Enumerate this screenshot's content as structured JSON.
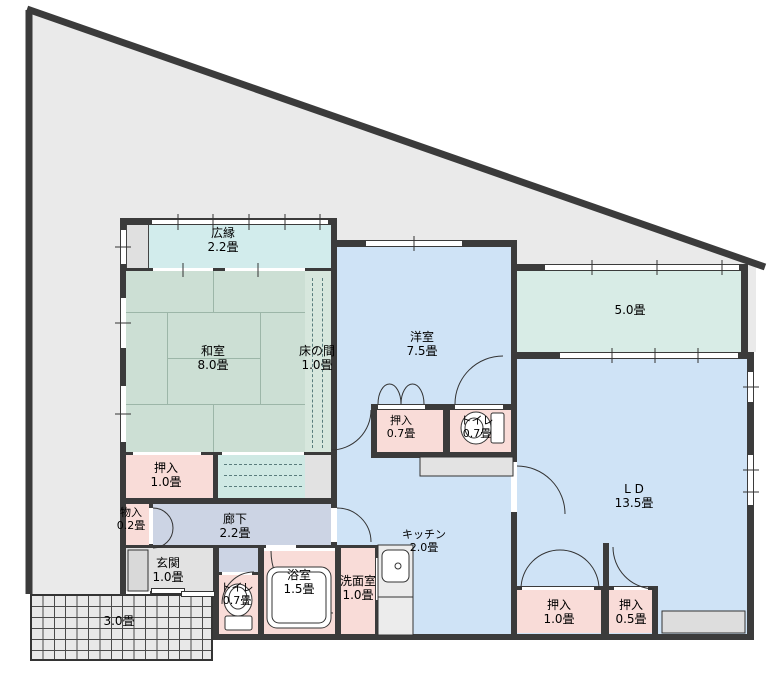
{
  "floor_plan": {
    "rooms": [
      {
        "id": "hiroen",
        "label": "広縁",
        "size": "2.2畳"
      },
      {
        "id": "washitsu",
        "label": "和室",
        "size": "8.0畳"
      },
      {
        "id": "tokonoma",
        "label": "床の間",
        "size": "1.0畳"
      },
      {
        "id": "youshitsu",
        "label": "洋室",
        "size": "7.5畳"
      },
      {
        "id": "room-5",
        "label": "",
        "size": "5.0畳"
      },
      {
        "id": "living-dining",
        "label": "L D",
        "size": "13.5畳"
      },
      {
        "id": "oshiire-youshitsu",
        "label": "押入",
        "size": "0.7畳"
      },
      {
        "id": "toilet-upper",
        "label": "トイレ",
        "size": "0.7畳"
      },
      {
        "id": "oshiire-washitsu",
        "label": "押入",
        "size": "1.0畳"
      },
      {
        "id": "monoire",
        "label": "物入",
        "size": "0.2畳"
      },
      {
        "id": "rouka",
        "label": "廊下",
        "size": "2.2畳"
      },
      {
        "id": "genkan",
        "label": "玄関",
        "size": "1.0畳"
      },
      {
        "id": "toilet-lower",
        "label": "トイレ",
        "size": "0.7畳"
      },
      {
        "id": "yokushitsu",
        "label": "浴室",
        "size": "1.5畳"
      },
      {
        "id": "senmenshitsu",
        "label": "洗面室",
        "size": "1.0畳"
      },
      {
        "id": "kitchen",
        "label": "キッチン",
        "size": "2.0畳"
      },
      {
        "id": "oshiire-ld-large",
        "label": "押入",
        "size": "1.0畳"
      },
      {
        "id": "oshiire-ld-small",
        "label": "押入",
        "size": "0.5畳"
      },
      {
        "id": "terrace",
        "label": "",
        "size": "3.0畳"
      }
    ],
    "fixtures": [
      "toilet",
      "toilet",
      "bathtub",
      "kitchen-sink"
    ],
    "palette": {
      "wall": "#3b3b3b",
      "site": "#eaeaea",
      "tatami": "#ccdfd4",
      "veranda": "#d2ecec",
      "western_floor": "#cfe3f6",
      "service_pink": "#f9dcd8",
      "corridor": "#ccd4e4",
      "room5_green": "#d8ece6"
    }
  }
}
